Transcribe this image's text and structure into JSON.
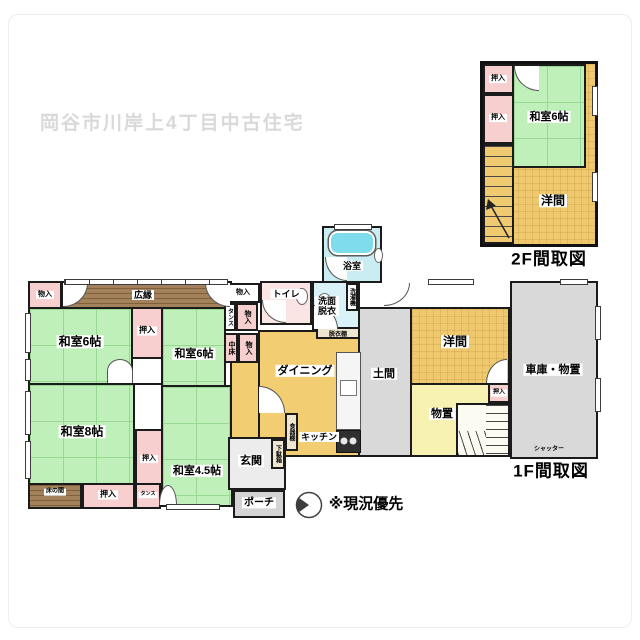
{
  "watermark": "岡谷市川岸上4丁目中古住宅",
  "note": "※現況優先",
  "colors": {
    "tatami_green": "#c0f0ba",
    "western_yellow": "#f0c96e",
    "storage_pale_yellow": "#f8f2b2",
    "closet_pink": "#f8cfcf",
    "bath_cyan": "#c9edf3",
    "bathtub_cyan": "#7edcec",
    "wood_brown": "#a3825b",
    "concrete_gray": "#d9d9d9",
    "wall_black": "#1b1b1b",
    "watermark_gray": "#d9d9d9"
  },
  "f1": {
    "caption": "1F間取図",
    "monoiri_tl": "物入",
    "hiroen": "広縁",
    "monoiri_tr": "物入",
    "toilet": "トイレ",
    "bath": "浴室",
    "senmen": "洗面脱衣",
    "sentakuki": "洗濯機",
    "datsuidana": "脱衣棚",
    "washitsu6_a": "和室6帖",
    "oshiire_a": "押入",
    "washitsu6_b": "和室6帖",
    "tansu_a": "タンス",
    "monoiri_c": "物入",
    "nakadoko": "中床",
    "monoiri_d": "物入",
    "washitsu8": "和室8帖",
    "tokonoma": "床の間",
    "oshiire_b": "押入",
    "tansu_b": "タンス",
    "oshiire_c": "押入",
    "washitsu45": "和室4.5帖",
    "dining": "ダイニング",
    "kitchen": "キッチン",
    "shokkidana": "食器棚",
    "getabako": "下駄箱",
    "genkan": "玄関",
    "porch": "ポーチ",
    "doma": "土間",
    "yoma": "洋間",
    "monooki": "物置",
    "oshiire_d": "押入",
    "garage": "車庫・物置",
    "shutter": "シャッター"
  },
  "f2": {
    "caption": "2F間取図",
    "oshiire_a": "押入",
    "oshiire_b": "押入",
    "washitsu6": "和室6帖",
    "yoma": "洋間"
  }
}
